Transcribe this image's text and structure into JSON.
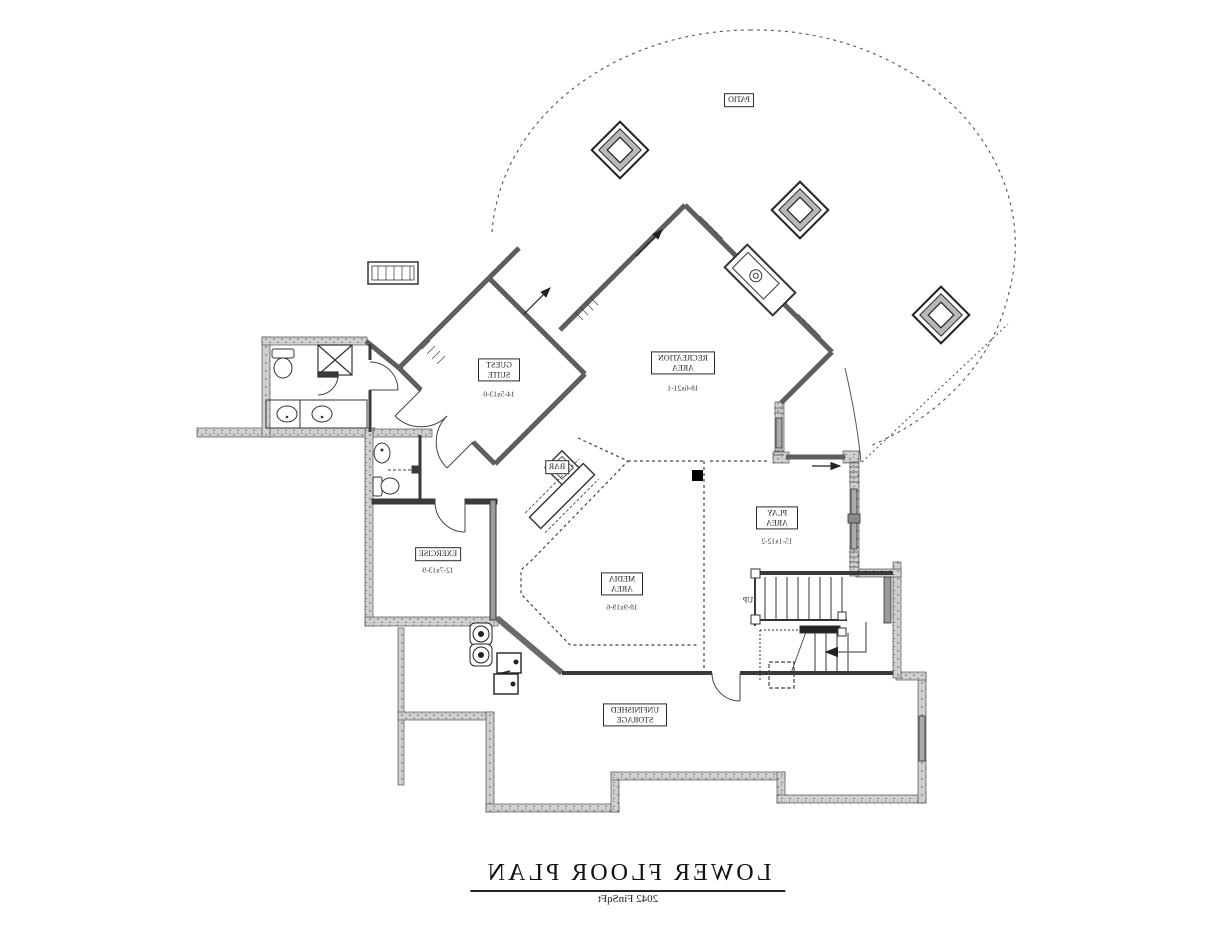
{
  "title": {
    "text": "LOWER FLOOR PLAN",
    "area": "2042 FinSqFt"
  },
  "rooms": {
    "patio": {
      "name": "PATIO"
    },
    "recreation": {
      "name": "RECREATION AREA",
      "dims": "18-6x21-1"
    },
    "guest": {
      "name": "GUEST SUITE",
      "dims": "14-5x13-0"
    },
    "bar": {
      "name": "BAR"
    },
    "play": {
      "name": "PLAY AREA",
      "dims": "15-1x12-2"
    },
    "media": {
      "name": "MEDIA AREA",
      "dims": "18-9x19-6"
    },
    "exercise": {
      "name": "EXERCISE",
      "dims": "12-7x13-9"
    },
    "storage": {
      "name": "UNFINISHED STORAGE"
    }
  },
  "stairs": {
    "direction_label": "UP"
  },
  "colors": {
    "ink": "#2b2b2b",
    "foundation_fill": "#cfcfcf"
  }
}
